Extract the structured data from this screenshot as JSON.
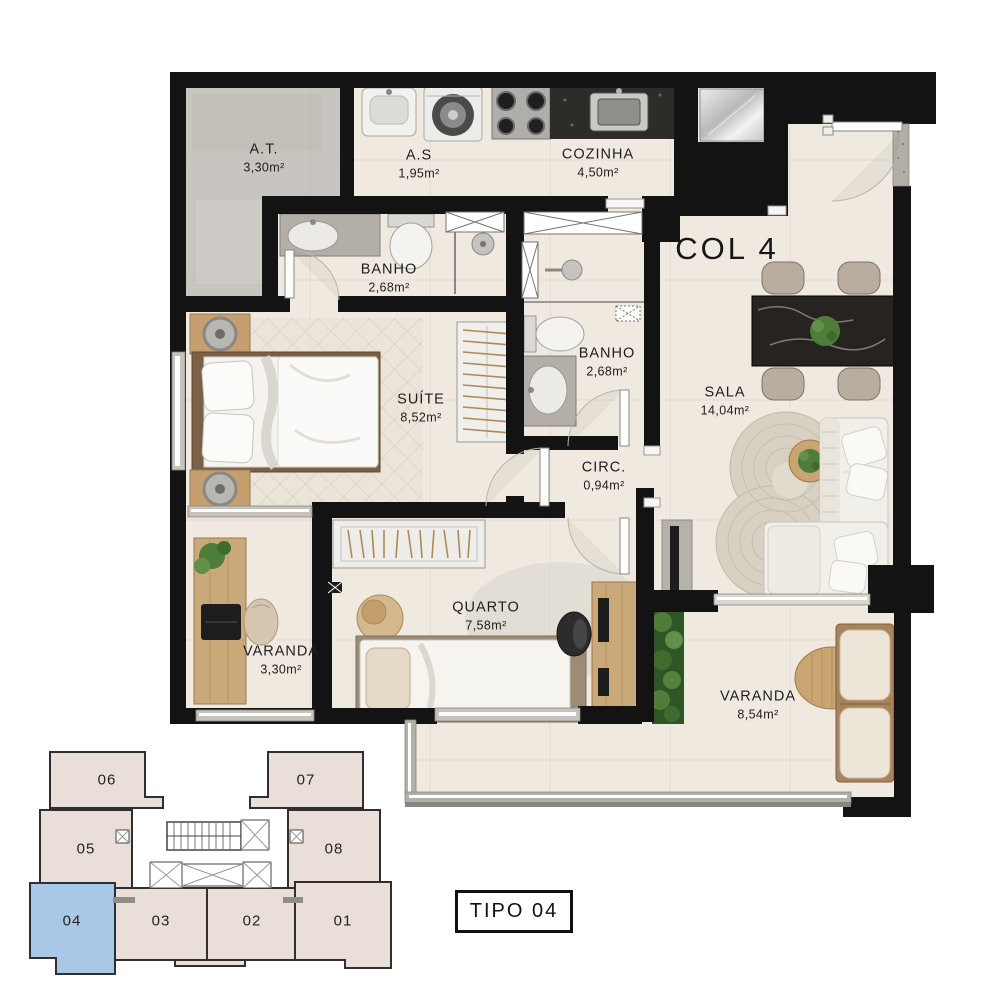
{
  "plan": {
    "column_label": "COL 4",
    "type_label": "TIPO 04",
    "rooms": [
      {
        "id": "at",
        "name": "A.T.",
        "area": "3,30m²"
      },
      {
        "id": "as",
        "name": "A.S",
        "area": "1,95m²"
      },
      {
        "id": "cozinha",
        "name": "COZINHA",
        "area": "4,50m²"
      },
      {
        "id": "banho1",
        "name": "BANHO",
        "area": "2,68m²"
      },
      {
        "id": "banho2",
        "name": "BANHO",
        "area": "2,68m²"
      },
      {
        "id": "suite",
        "name": "SUÍTE",
        "area": "8,52m²"
      },
      {
        "id": "sala",
        "name": "SALA",
        "area": "14,04m²"
      },
      {
        "id": "circ",
        "name": "CIRC.",
        "area": "0,94m²"
      },
      {
        "id": "quarto",
        "name": "QUARTO",
        "area": "7,58m²"
      },
      {
        "id": "varanda1",
        "name": "VARANDA",
        "area": "3,30m²"
      },
      {
        "id": "varanda2",
        "name": "VARANDA",
        "area": "8,54m²"
      }
    ]
  },
  "key_plan": {
    "highlighted_unit": "04",
    "units": [
      {
        "number": "06"
      },
      {
        "number": "07"
      },
      {
        "number": "05"
      },
      {
        "number": "08"
      },
      {
        "number": "04"
      },
      {
        "number": "03"
      },
      {
        "number": "02"
      },
      {
        "number": "01"
      }
    ]
  },
  "colors": {
    "wall": "#131313",
    "floor": "#efe9e0",
    "concrete": "#c8c5c0",
    "counter_dark": "#2e2c29",
    "wood": "#c9a87a",
    "rug": "#d8d1c2",
    "plant": "#4e7d3a",
    "keyplan_unit": "#e9dfd8",
    "keyplan_highlight": "#a9c7e6",
    "window": "#c6c3bd"
  }
}
